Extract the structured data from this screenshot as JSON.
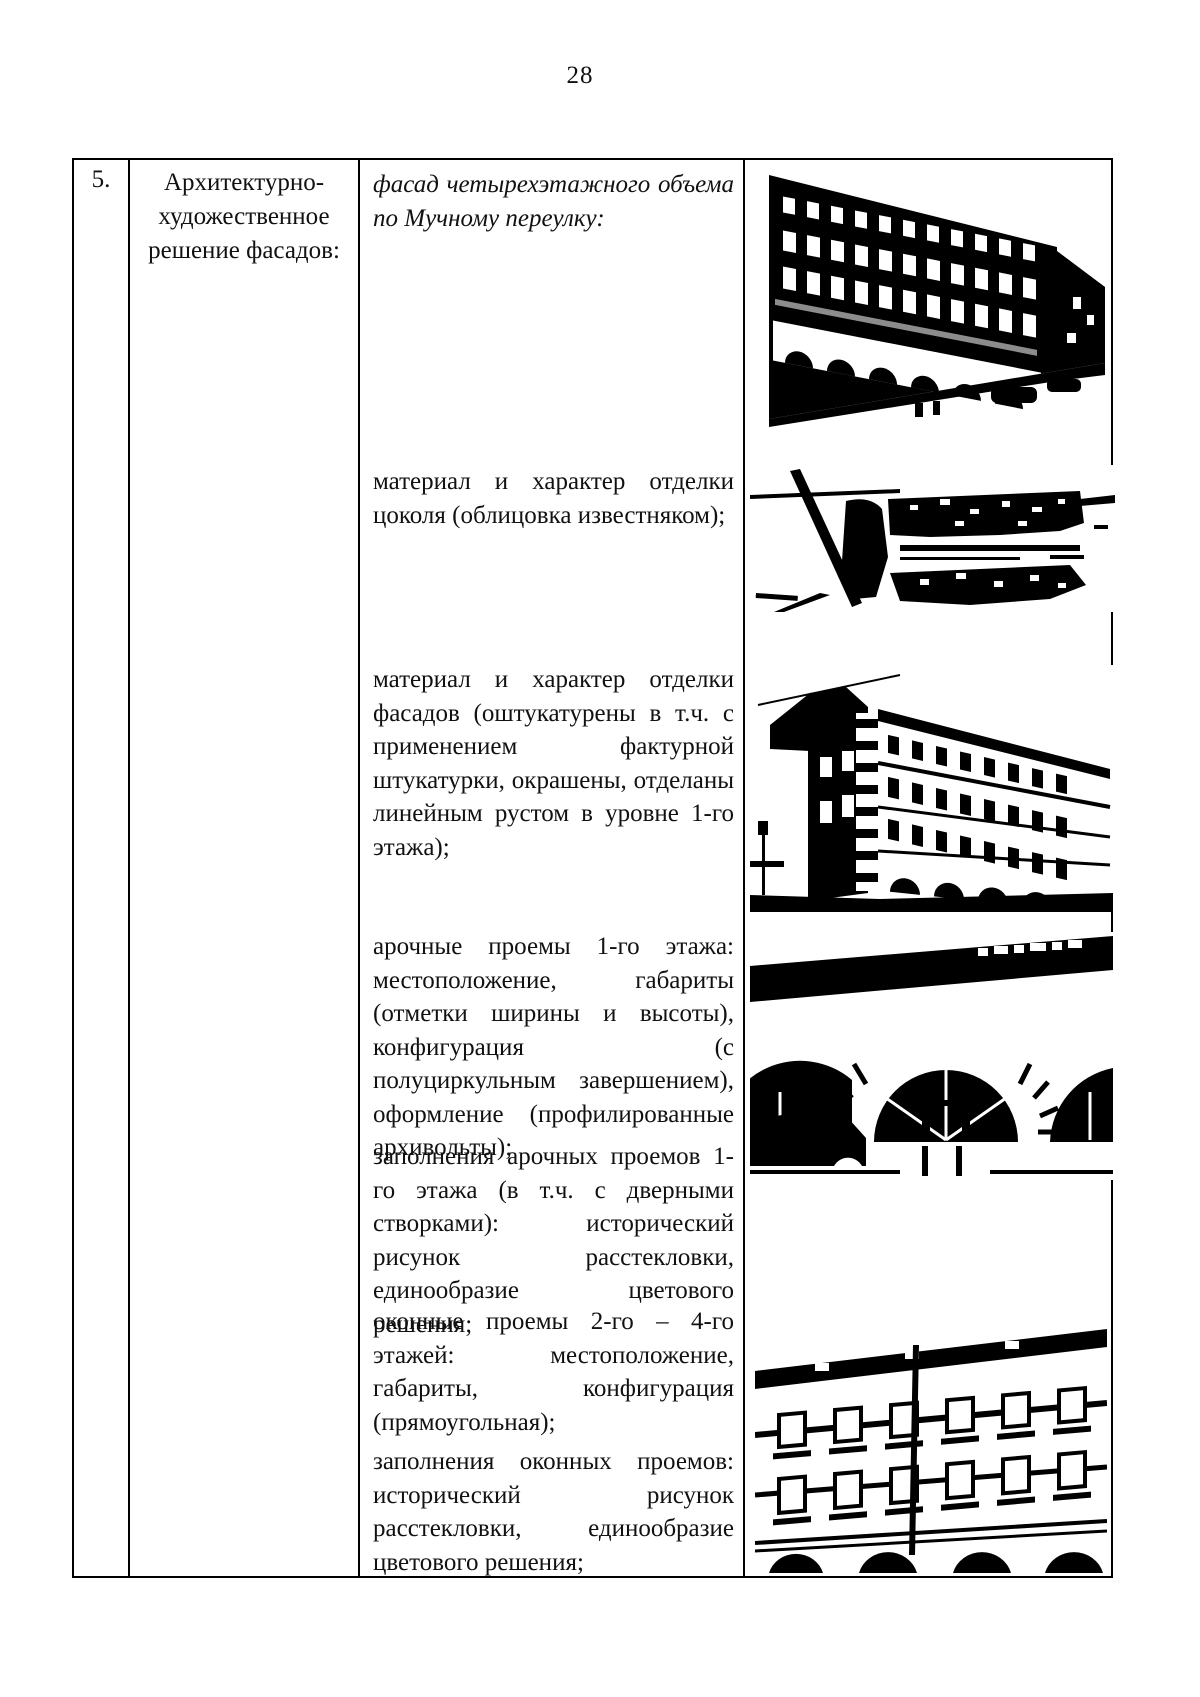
{
  "page": {
    "number": "28"
  },
  "table": {
    "row_number": "5.",
    "row_title": "Архитектурно-художественное решение фасадов:",
    "items": [
      {
        "text": "фасад четырехэтажного объема по Мучному переулку:"
      },
      {
        "text": "материал и характер отделки цоколя (облицовка известняком);"
      },
      {
        "text": "материал и характер отделки фасадов (оштукатурены в т.ч. с применением фактурной штукатурки, окрашены, отделаны линейным рустом в уровне 1-го этажа);"
      },
      {
        "text": "арочные проемы 1-го этажа: местоположение, габариты (отметки ширины и высоты), конфигурация (с полуциркульным завершением), оформление (профилированные архивольты);"
      },
      {
        "text": "заполнения арочных проемов 1-го этажа (в т.ч. с дверными створками): исторический рисунок расстекловки, единообразие цветового решения;"
      },
      {
        "text": "оконные проемы 2-го – 4-го этажей: местоположение, габариты, конфигурация (прямоугольная);"
      },
      {
        "text": "заполнения оконных проемов: исторический рисунок расстекловки, единообразие цветового решения;"
      }
    ],
    "photos": [
      {
        "name": "four-story-facade-muchny-lane-photo"
      },
      {
        "name": "limestone-plinth-closeup-photo"
      },
      {
        "name": "corner-facade-plaster-rustication-photo"
      },
      {
        "name": "arched-first-floor-openings-photo"
      },
      {
        "name": "upper-floor-window-openings-photo"
      }
    ],
    "colors": {
      "ink": "#000000",
      "paper": "#ffffff"
    }
  }
}
